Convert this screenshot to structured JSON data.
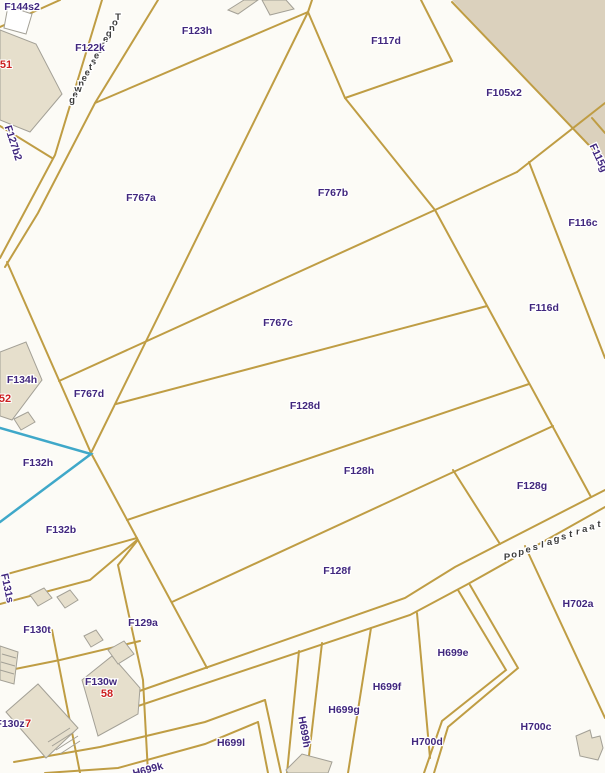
{
  "map": {
    "background_color": "#fcfbf6",
    "boundary_color": "#bf9d44",
    "highlight_color": "#3fa8c9",
    "parcel_label_color": "#41277e",
    "house_number_color": "#cc2020",
    "building_fill_color": "#e6dfcc",
    "urban_area_color": "#dbd1bd"
  },
  "streets": {
    "tongersesteenweg": "Tongersesteenweg",
    "popeslagstraat": "Popeslagstraat"
  },
  "parcels": {
    "f144s2": "F144s2",
    "f122k": "F122k",
    "f127b2": "F127b2",
    "f123h": "F123h",
    "f117d": "F117d",
    "f105x2": "F105x2",
    "f115g": "F115g",
    "f767a": "F767a",
    "f767b": "F767b",
    "f767c": "F767c",
    "f767d": "F767d",
    "f116c": "F116c",
    "f116d": "F116d",
    "f128d": "F128d",
    "f128h": "F128h",
    "f128g": "F128g",
    "f128f": "F128f",
    "f134h": "F134h",
    "f132h": "F132h",
    "f132b": "F132b",
    "f131s": "F131s",
    "f130t": "F130t",
    "f129a": "F129a",
    "f130w": "F130w",
    "f130z": "F130z",
    "h702a": "H702a",
    "h699e": "H699e",
    "h699f": "H699f",
    "h699g": "H699g",
    "h699h": "H699h",
    "h699l": "H699l",
    "h699k": "H699k",
    "h700c": "H700c",
    "h700d": "H700d"
  },
  "house_numbers": {
    "n51": "51",
    "n52": "52",
    "n58": "58",
    "n7": "7"
  }
}
